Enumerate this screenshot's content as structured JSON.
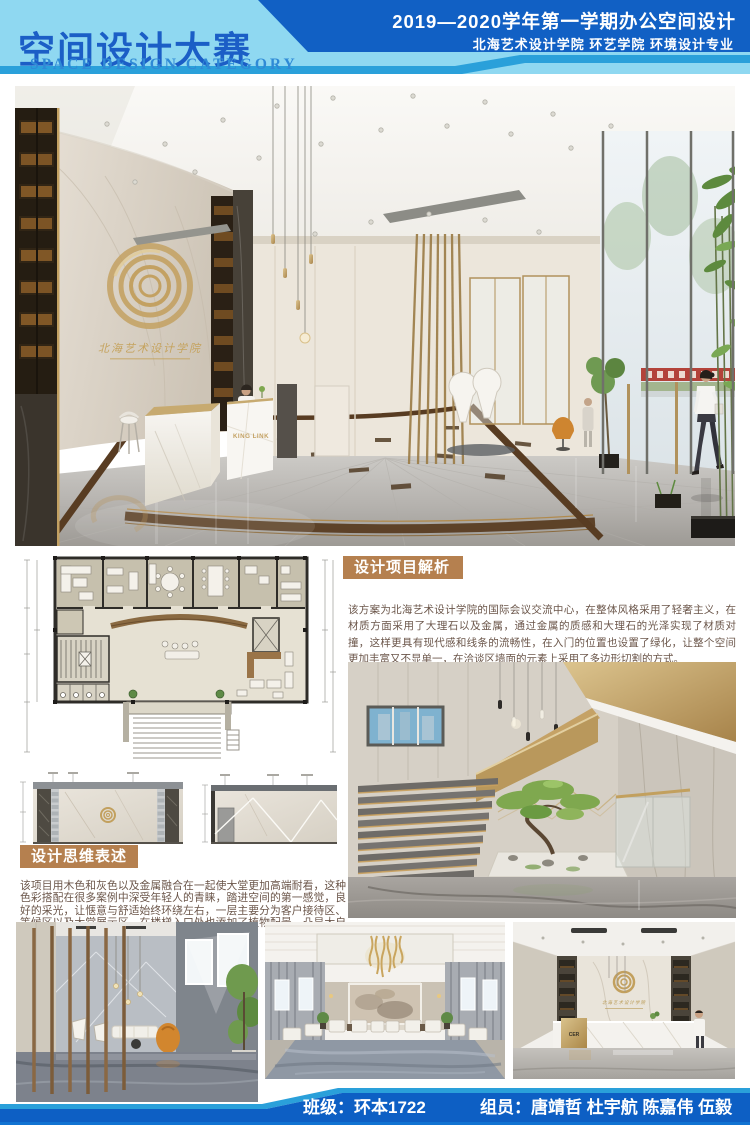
{
  "header": {
    "title_cn": "空间设计大赛",
    "title_en": "SPACE DESIGN CATEGORY",
    "term_line": "2019—2020学年第一学期办公空间设计",
    "school_line": "北海艺术设计学院  环艺学院  环境设计专业",
    "colors": {
      "light_blue": "#8FD8F1",
      "dark_blue": "#1160C4",
      "mid_blue": "#2AA0DA",
      "title_blue": "#1B5EC6"
    }
  },
  "hero": {
    "wall_logo_text": "北海艺术设计学院",
    "desk_logo_text": "KING LINK"
  },
  "analysis": {
    "label": "设计项目解析",
    "body": "该方案为北海艺术设计学院的国际会议交流中心，在整体风格采用了轻奢主义，在材质方面采用了大理石以及金属，通过金属的质感和大理石的光泽实现了材质对撞，这样更具有现代感和线条的流畅性，在入门的位置也设置了绿化，让整个空间更加丰富又不显单一，在洽谈区墙面的元素上采用了多边形切割的方式。"
  },
  "thinking": {
    "label": "设计思维表述",
    "body": "该项目用木色和灰色以及金属融合在一起使大堂更加高端耐看，这种色彩搭配在很多案例中深受年轻人的青睐，踏进空间的第一感觉，良好的采光，让惬意与舒适始终环绕左右，一层主要分为客户接待区、等候区以及大堂展示区，在楼梯入口处也添加了植物配景，凸显大自然的元素。"
  },
  "gallery": {
    "reception_sign_text": "CER"
  },
  "footer": {
    "class_label": "班级：环本1722",
    "members_label": "组员：唐靖哲  杜宇航  陈嘉伟  伍毅",
    "bar_blue": "#0D5FC4"
  },
  "accent": {
    "label_gold": "#B5804F",
    "body_text": "#6B564A"
  }
}
